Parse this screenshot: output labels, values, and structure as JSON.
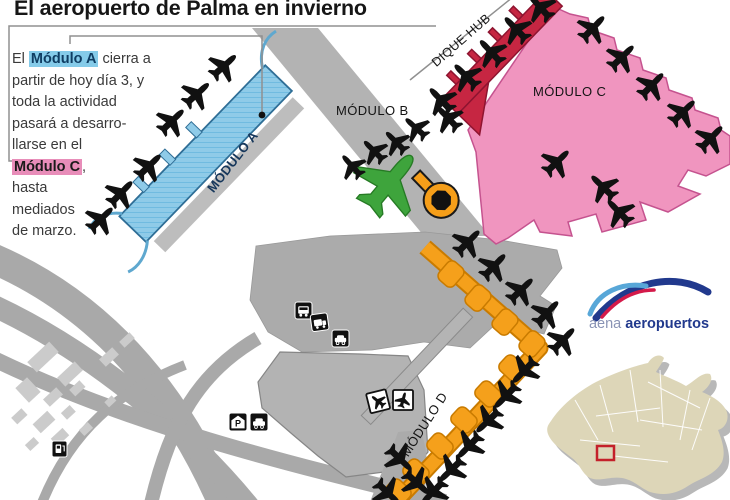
{
  "title": "El aeropuerto de Palma en invierno",
  "callout": {
    "line1_pre": "El ",
    "line1_highlight": "Módulo A",
    "line1_post": " cierra a",
    "line2": "partir de hoy día 3, y",
    "line3": "toda la actividad",
    "line4": "pasará a desarro-",
    "line5": "llarse en el",
    "line6_highlight": "Módulo C",
    "line6_post": ",",
    "line7": "hasta",
    "line8": "mediados",
    "line9": "de marzo."
  },
  "labels": {
    "module_a": "MÓDULO A",
    "module_b": "MÓDULO B",
    "module_c": "MÓDULO C",
    "module_d": "MÓDULO D",
    "dique_hub": "DIQUE HUB"
  },
  "logo": {
    "brand": "aena",
    "suffix": "aeropuertos"
  },
  "icons": {
    "parking_letter": "P",
    "names": [
      "bus-icon",
      "shuttle-bus-icon",
      "car-icon",
      "parking-garage-icon",
      "rental-car-icon",
      "terminal-plane-badge-icon",
      "terminal-plane-badge-icon-2",
      "fuel-station-icon",
      "airplane-silhouette-icon",
      "control-tower-icon"
    ]
  },
  "colors": {
    "module_a": "#85CBE9",
    "module_a_stroke": "#2F6E96",
    "module_b": "#3EA43C",
    "module_c": "#F095BF",
    "module_c_stroke": "#C5538F",
    "dique_hub": "#C62642",
    "module_d": "#F5A01B",
    "module_d_stroke": "#C97B00",
    "terminal_gray": "#ABABAB",
    "light_buildings": "#CBCBCB",
    "island_fill": "#DDD6B8",
    "marker_red": "#C4202A",
    "logo_blue": "#21398D",
    "logo_red": "#D41A4A",
    "logo_lightblue": "#58A7D8",
    "highlight_a_bg": "#85CBE9",
    "highlight_c_bg": "#E88DB9",
    "plane_black": "#111111"
  }
}
